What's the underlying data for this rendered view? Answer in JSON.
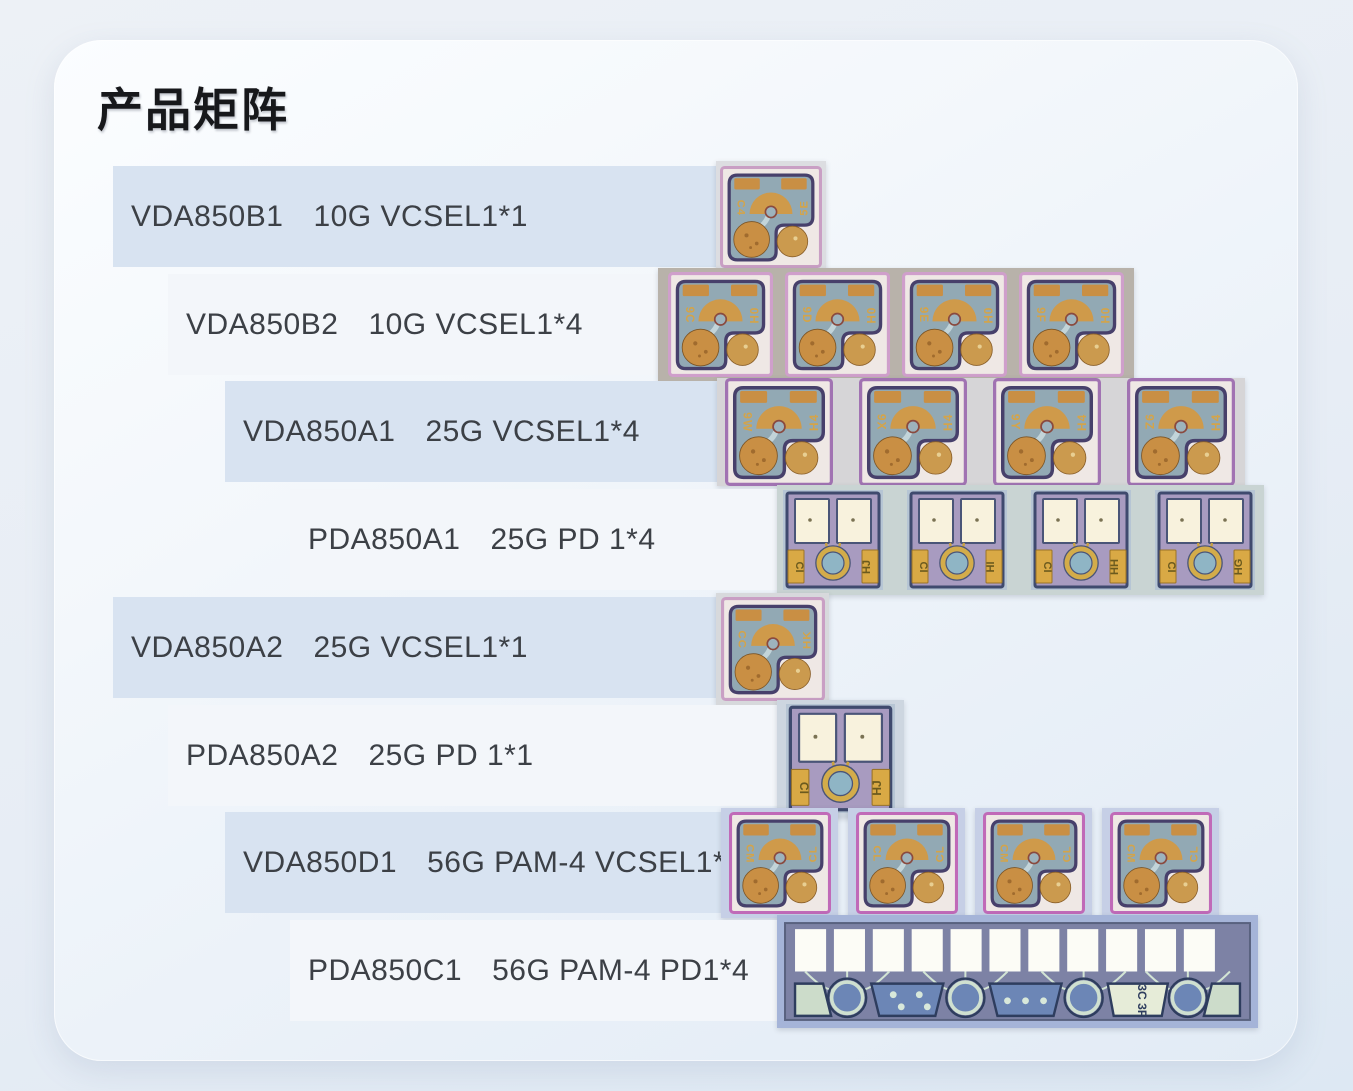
{
  "page": {
    "title": "产品矩阵"
  },
  "rows": [
    {
      "model": "VDA850B1",
      "spec": "10G VCSEL1*1",
      "chip_type": "vcsel",
      "chip_count": 1,
      "chips": [
        {
          "left": "C4",
          "right": "5E"
        }
      ]
    },
    {
      "model": "VDA850B2",
      "spec": "10G VCSEL1*4",
      "chip_type": "vcsel",
      "chip_count": 4,
      "chips": [
        {
          "left": "9C",
          "right": "H0"
        },
        {
          "left": "9D",
          "right": "H0"
        },
        {
          "left": "9E",
          "right": "H0"
        },
        {
          "left": "9F",
          "right": "H0"
        }
      ]
    },
    {
      "model": "VDA850A1",
      "spec": "25G VCSEL1*4",
      "chip_type": "vcsel",
      "chip_count": 4,
      "chips": [
        {
          "left": "9W",
          "right": "H4"
        },
        {
          "left": "9X",
          "right": "H4"
        },
        {
          "left": "9Y",
          "right": "H4"
        },
        {
          "left": "9Z",
          "right": "H4"
        }
      ]
    },
    {
      "model": "PDA850A1",
      "spec": "25G PD 1*4",
      "chip_type": "pd",
      "chip_count": 4,
      "chips": [
        {
          "left": "CI",
          "right": "HJ"
        },
        {
          "left": "CI",
          "right": "HI"
        },
        {
          "left": "CI",
          "right": "HH"
        },
        {
          "left": "CI",
          "right": "HG"
        }
      ]
    },
    {
      "model": "VDA850A2",
      "spec": "25G VCSEL1*1",
      "chip_type": "vcsel",
      "chip_count": 1,
      "chips": [
        {
          "left": "CC",
          "right": "HK"
        }
      ]
    },
    {
      "model": "PDA850A2",
      "spec": "25G PD 1*1",
      "chip_type": "pd",
      "chip_count": 1,
      "chips": [
        {
          "left": "CI",
          "right": "HJ"
        }
      ]
    },
    {
      "model": "VDA850D1",
      "spec": "56G PAM-4 VCSEL1*4",
      "chip_type": "vcsel",
      "chip_count": 4,
      "chips": [
        {
          "left": "CM",
          "right": "CL"
        },
        {
          "left": "CL",
          "right": "CL"
        },
        {
          "left": "CM",
          "right": "CL"
        },
        {
          "left": "CM",
          "right": "CL"
        }
      ]
    },
    {
      "model": "PDA850C1",
      "spec": "56G PAM-4 PD1*4",
      "chip_type": "pd_array",
      "chip_count": 1,
      "chips": [
        {
          "label": "3C 3F"
        }
      ]
    }
  ],
  "colors": {
    "bar_blue": "#d8e3f1",
    "bar_white": "#f3f6fa",
    "title_text": "#17181b",
    "row_text": "#3c4046"
  }
}
